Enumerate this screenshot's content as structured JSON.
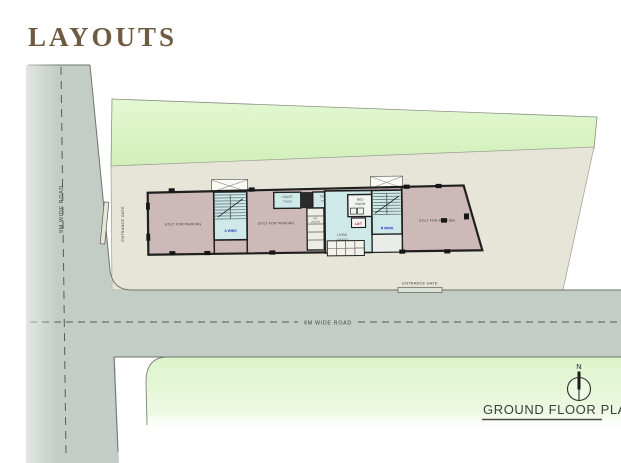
{
  "title": "LAYOUTS",
  "plan_name": "GROUND FLOOR PLAN",
  "compass": {
    "north_label": "N"
  },
  "roads": {
    "left_label": "9M WIDE ROAD",
    "bottom_label": "6M WIDE ROAD"
  },
  "gates": {
    "left_label": "ENTRANCE GATE",
    "bottom_label": "ENTRANCE GATE"
  },
  "building": {
    "parking_left": "STILT FOR PARKING",
    "parking_middle": "STILT FOR PARKING",
    "parking_right": "STILT FOR PARKING",
    "stair_a": "A WING",
    "stair_b": "B WING",
    "lift_label": "LIFT",
    "rooms": {
      "living": {
        "name": "LIVING",
        "dims": "12'4X10'7"
      },
      "bed": {
        "name": "BED",
        "name2": "ROOM"
      },
      "toilet1": {
        "name": "TOILET",
        "dims": "7'0X5'0"
      },
      "toilet2": {
        "name": "TOILET",
        "dims": "7'0X5'0"
      },
      "kitchen": {
        "name": "KIT.",
        "dims": "2'6X7'0"
      }
    }
  },
  "colors": {
    "title_brown": "#6f5b41",
    "lawn_green": "#d9f2c5",
    "road_gray": "#c3ccc5",
    "plot_beige": "#e6e5d8",
    "parking_pink": "#ccb9b8",
    "room_blue": "#cfe9e8",
    "wall_dark": "#1f1f1f",
    "lift_red": "#e00020",
    "wing_blue": "#2233cc"
  }
}
